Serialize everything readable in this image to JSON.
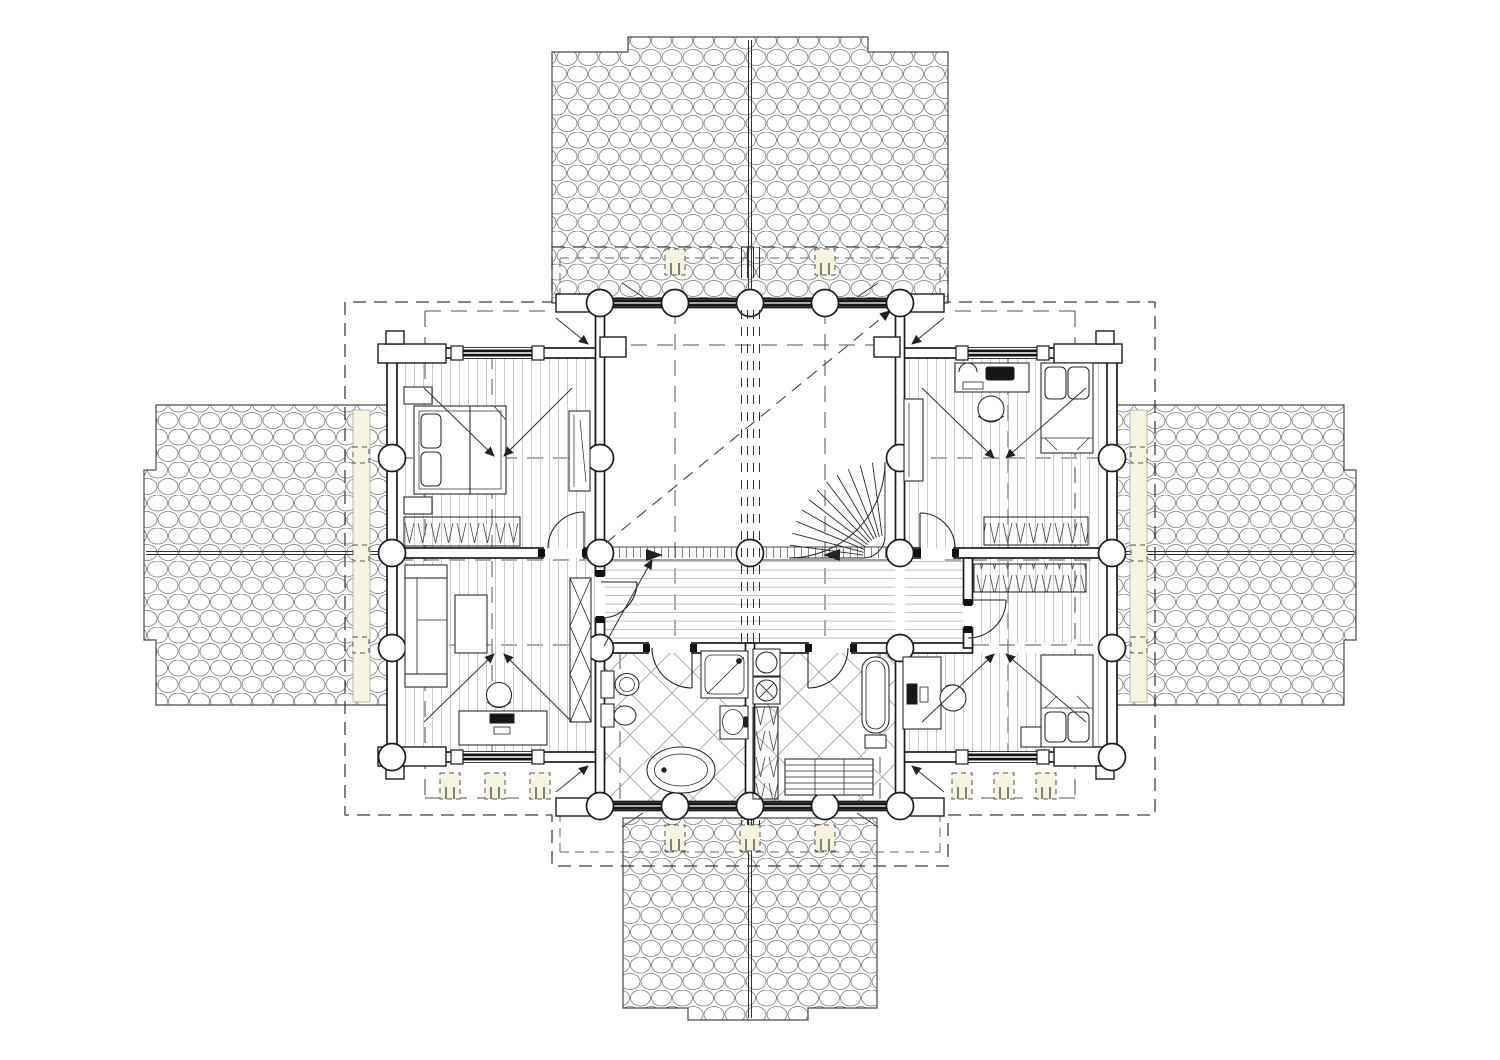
{
  "document": {
    "type": "architectural-floor-plan",
    "view": "upper floor of cruciform log house",
    "style": "monochrome CAD linework on white sheet"
  },
  "colors": {
    "paper": "#ffffff",
    "line": "#1c1c1c",
    "roof_line": "#777777",
    "floor_line": "#bdbdbd",
    "tile_line": "#9c9c9c",
    "dash": "#444444",
    "deck": "#f6f3e0",
    "glazing": "#161616"
  },
  "plan": {
    "shape": "cross-shaped plan with four shingled roof wings",
    "log_columns_count": 25,
    "doors_count": 6,
    "windows_count": 6,
    "stair": {
      "type": "quarter-turn winder stair",
      "treads": 13
    },
    "roof_sections": [
      {
        "position": "top",
        "hatch": "shingle",
        "ridge": "vertical"
      },
      {
        "position": "left",
        "hatch": "shingle",
        "ridge": "horizontal"
      },
      {
        "position": "right",
        "hatch": "shingle",
        "ridge": "horizontal"
      },
      {
        "position": "bottom",
        "hatch": "shingle",
        "ridge": "vertical"
      }
    ],
    "rooms": [
      {
        "name": "bedroom-northwest",
        "floor": "plank",
        "furniture": [
          "double-bed",
          "nightstand",
          "nightstand",
          "hanging-wardrobe",
          "tall-cabinet"
        ]
      },
      {
        "name": "study-southwest",
        "floor": "plank",
        "furniture": [
          "sofa",
          "coffee-table",
          "desk-with-computer",
          "office-chair",
          "lattice-cabinet"
        ]
      },
      {
        "name": "hall-void-center",
        "floor": "open",
        "features": [
          "guard-rail-with-balusters",
          "winder-stair",
          "slope-arrow",
          "ridge-beam-marks"
        ]
      },
      {
        "name": "corridor-center",
        "floor": "plank"
      },
      {
        "name": "bathroom-west",
        "floor": "diagonal-tile",
        "fixtures": [
          "toilet",
          "bidet",
          "shower-cabin",
          "washbasin",
          "bathtub"
        ]
      },
      {
        "name": "sauna-east",
        "floor": "diagonal-tile",
        "fixtures": [
          "washing-machine",
          "washer-dryer",
          "sauna-heater",
          "water-heater",
          "bench"
        ]
      },
      {
        "name": "bedroom-northeast",
        "floor": "plank",
        "furniture": [
          "desk-with-computer",
          "office-chair",
          "single-bed",
          "hanging-wardrobe",
          "tall-cabinet"
        ]
      },
      {
        "name": "bedroom-southeast",
        "floor": "plank",
        "furniture": [
          "desk-with-computer",
          "office-chair",
          "single-bed",
          "hanging-wardrobe",
          "side-table"
        ]
      },
      {
        "name": "vestibule-east",
        "floor": "plank"
      }
    ],
    "annotations": [
      "dashed-overhang-outline",
      "slope-direction-arrows",
      "balcony-post-symbols",
      "deck-strips"
    ]
  }
}
